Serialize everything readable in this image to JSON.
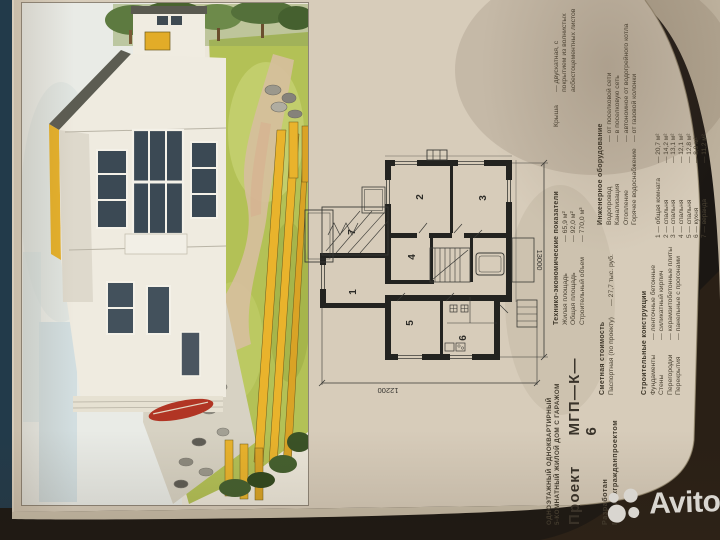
{
  "photo": {
    "watermark": "Avito"
  },
  "page": {
    "title_line1": "ОДНОЭТАЖНЫЙ ОДНОКВАРТИРНЫЙ",
    "title_line2": "5-КОМНАТНЫЙ ЖИЛОЙ ДОМ С ГАРАЖОМ",
    "project_label": "Проект",
    "project_code": "МГП—К—6",
    "developed_label": "Разработан",
    "developer": "Марийскгражданпроектом"
  },
  "tech": {
    "header": "Технико-экономические показатели",
    "rows": [
      {
        "label": "Жилая площадь",
        "value": "— 65,9 м²"
      },
      {
        "label": "Общая площадь",
        "value": "— 92,0 м²"
      },
      {
        "label": "Строительный объем",
        "value": "— 770,0 м³"
      }
    ]
  },
  "cost": {
    "header": "Сметная стоимость",
    "rows": [
      {
        "label": "Паспортная (по проекту)",
        "value": "— 27,7 тыс. руб."
      }
    ]
  },
  "construction": {
    "header": "Строительные конструкции",
    "rows": [
      {
        "label": "Фундаменты",
        "value": "— ленточные бетонные"
      },
      {
        "label": "Стены",
        "value": "— силикатный кирпич"
      },
      {
        "label": "Перегородки",
        "value": "— керамзитобетонные плиты"
      },
      {
        "label": "Перекрытия",
        "value": "— панельные с прогонами"
      }
    ]
  },
  "roof": {
    "label": "Крыша",
    "value": "— двускатная, с покрытием из волнистых асбестоцементных листов"
  },
  "engineering": {
    "header": "Инженерное оборудование",
    "rows": [
      {
        "label": "Водопровод",
        "value": "— от поселковой сети"
      },
      {
        "label": "Канализация",
        "value": "— в поселковую сеть"
      },
      {
        "label": "Отопление",
        "value": "— автономное от водогрейного котла"
      },
      {
        "label": "Горячее водоснабжение",
        "value": "— от газовой колонки"
      }
    ]
  },
  "rooms": {
    "rows": [
      {
        "label": "1 — общая комната",
        "value": "— 20,7 м²"
      },
      {
        "label": "2 — спальня",
        "value": "— 14,2 м²"
      },
      {
        "label": "3 — спальня",
        "value": "— 13,1 м²"
      },
      {
        "label": "4 — спальня",
        "value": "— 12,1 м²"
      },
      {
        "label": "5 — спальня",
        "value": "— 12,8 м²"
      },
      {
        "label": "6 — кухня",
        "value": "— 8,9 м²"
      },
      {
        "label": "7 — веранда",
        "value": "— 11,2 м²"
      }
    ]
  },
  "plan": {
    "room_numbers": [
      "1",
      "2",
      "3",
      "4",
      "5",
      "6",
      "7"
    ],
    "dim_right": "13000",
    "dim_bottom": "12200"
  },
  "colors": {
    "page": "#d7ccba",
    "ink": "#4b4334",
    "accent_yellow": "#e6b12a",
    "lawn_green": "#b3c156",
    "photo_dark": "#1b1713",
    "corner_blue": "#2c4a5c",
    "watermark_gray": "#d9d6d0"
  }
}
